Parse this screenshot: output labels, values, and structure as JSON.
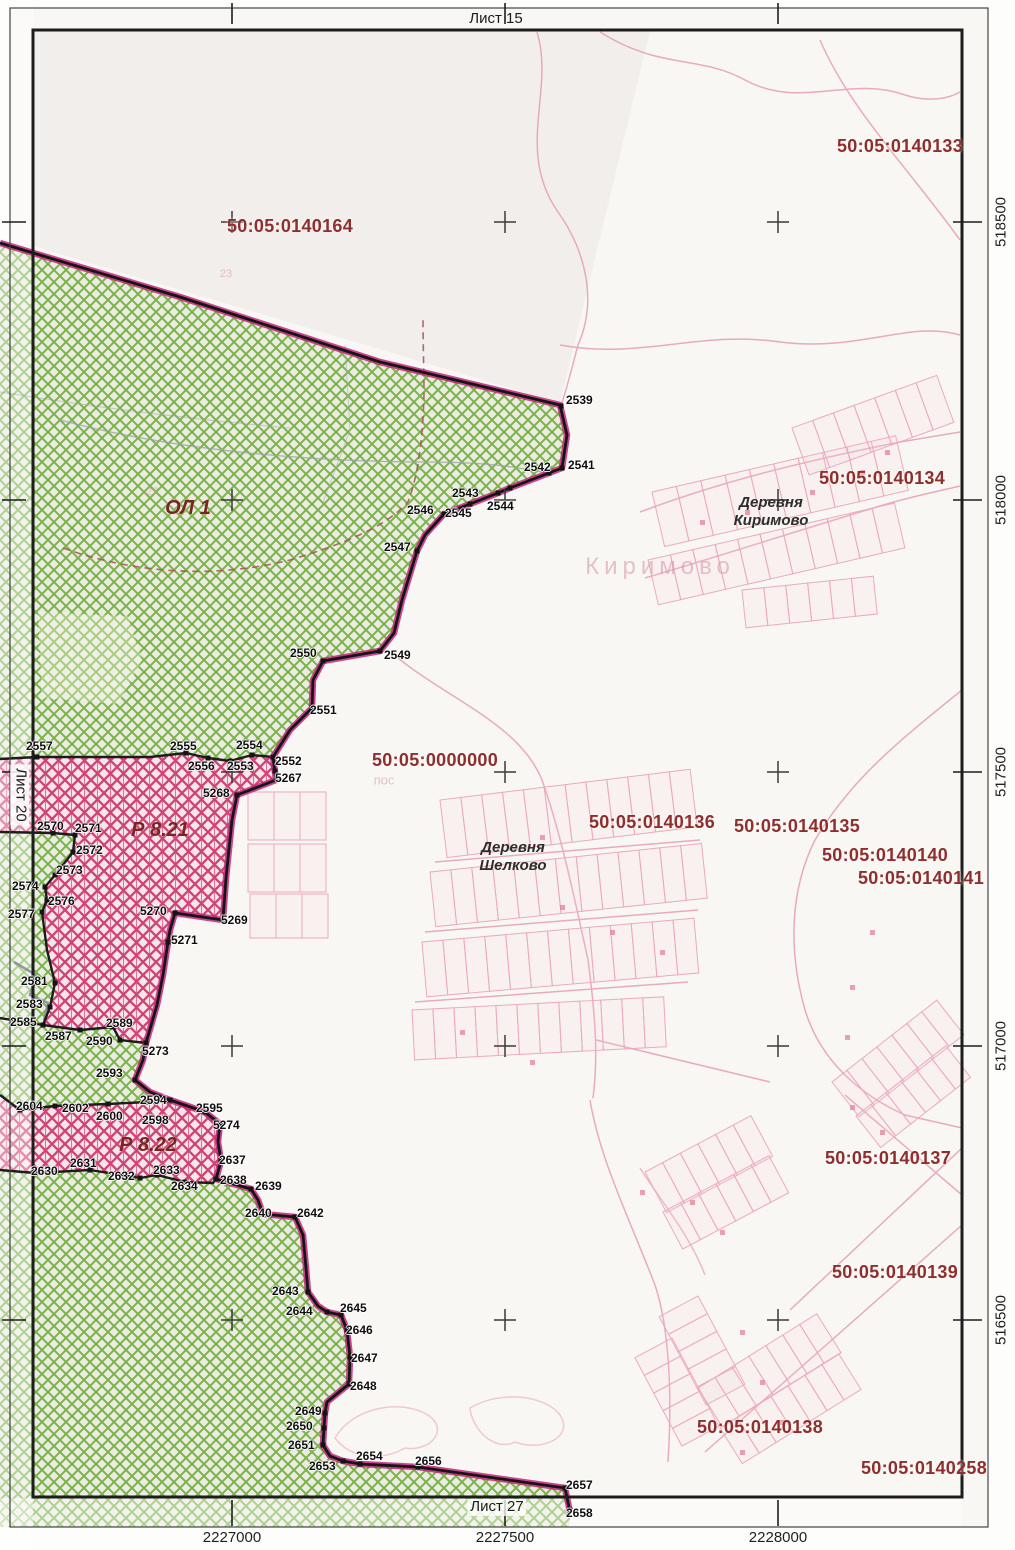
{
  "sheet": {
    "top": "Лист 15",
    "left": "Лист 20",
    "bottom": "Лист 27"
  },
  "grid": {
    "bottom_labels": [
      {
        "t": "2227000",
        "x": 232
      },
      {
        "t": "2227500",
        "x": 505
      },
      {
        "t": "2228000",
        "x": 778
      }
    ],
    "right_labels": [
      {
        "t": "518500",
        "y": 222
      },
      {
        "t": "518000",
        "y": 500
      },
      {
        "t": "517500",
        "y": 772
      },
      {
        "t": "517000",
        "y": 1046
      },
      {
        "t": "516500",
        "y": 1320
      }
    ]
  },
  "cadastral_quarters": [
    {
      "t": "50:05:0140133",
      "x": 900,
      "y": 146
    },
    {
      "t": "50:05:0140164",
      "x": 290,
      "y": 226
    },
    {
      "t": "50:05:0140134",
      "x": 882,
      "y": 478
    },
    {
      "t": "50:05:0000000",
      "x": 435,
      "y": 760
    },
    {
      "t": "50:05:0140136",
      "x": 652,
      "y": 822
    },
    {
      "t": "50:05:0140135",
      "x": 797,
      "y": 826
    },
    {
      "t": "50:05:0140140",
      "x": 885,
      "y": 855
    },
    {
      "t": "50:05:0140141",
      "x": 921,
      "y": 878
    },
    {
      "t": "50:05:0140137",
      "x": 888,
      "y": 1158
    },
    {
      "t": "50:05:0140139",
      "x": 895,
      "y": 1272
    },
    {
      "t": "50:05:0140138",
      "x": 760,
      "y": 1427
    },
    {
      "t": "50:05:0140258",
      "x": 924,
      "y": 1468
    }
  ],
  "regions": [
    {
      "t": "ОЛ 1",
      "x": 188,
      "y": 508
    },
    {
      "t": "Р 8.21",
      "x": 160,
      "y": 830
    },
    {
      "t": "Р 8.22",
      "x": 148,
      "y": 1145
    }
  ],
  "villages": [
    {
      "t": "Деревня\nКиримово",
      "x": 771,
      "y": 512
    },
    {
      "t": "Деревня\nШелково",
      "x": 513,
      "y": 857
    }
  ],
  "watermarks": [
    {
      "t": "Киримово",
      "x": 660,
      "y": 567,
      "size": 24
    },
    {
      "t": "пос",
      "x": 384,
      "y": 780,
      "size": 13
    },
    {
      "t": "23",
      "x": 226,
      "y": 274,
      "size": 11
    },
    {
      "t": "27",
      "x": 152,
      "y": 492,
      "size": 11
    }
  ],
  "points": [
    {
      "id": "2539",
      "lx": 566,
      "ly": 394,
      "vx": 561,
      "vy": 406
    },
    {
      "id": "2541",
      "lx": 568,
      "ly": 459,
      "vx": 562,
      "vy": 468
    },
    {
      "id": "2542",
      "lx": 524,
      "ly": 461,
      "vx": 549,
      "vy": 473
    },
    {
      "id": "2543",
      "lx": 452,
      "ly": 487,
      "vx": 510,
      "vy": 488
    },
    {
      "id": "2544",
      "lx": 487,
      "ly": 500,
      "vx": 498,
      "vy": 493
    },
    {
      "id": "2545",
      "lx": 445,
      "ly": 507,
      "vx": 470,
      "vy": 504
    },
    {
      "id": "2546",
      "lx": 407,
      "ly": 504,
      "vx": 444,
      "vy": 514
    },
    {
      "id": "2547",
      "lx": 384,
      "ly": 541,
      "vx": 417,
      "vy": 551
    },
    {
      "id": "2549",
      "lx": 384,
      "ly": 649,
      "vx": 380,
      "vy": 651
    },
    {
      "id": "2550",
      "lx": 290,
      "ly": 647,
      "vx": 323,
      "vy": 661
    },
    {
      "id": "2551",
      "lx": 310,
      "ly": 704,
      "vx": 312,
      "vy": 708
    },
    {
      "id": "2552",
      "lx": 275,
      "ly": 755,
      "vx": 273,
      "vy": 757
    },
    {
      "id": "5267",
      "lx": 275,
      "ly": 772,
      "vx": 275,
      "vy": 771
    },
    {
      "id": "2553",
      "lx": 227,
      "ly": 760,
      "vx": 230,
      "vy": 761
    },
    {
      "id": "2554",
      "lx": 236,
      "ly": 739,
      "vx": 252,
      "vy": 755
    },
    {
      "id": "2555",
      "lx": 170,
      "ly": 740,
      "vx": 186,
      "vy": 753
    },
    {
      "id": "2556",
      "lx": 188,
      "ly": 760,
      "vx": 208,
      "vy": 758
    },
    {
      "id": "2557",
      "lx": 26,
      "ly": 740,
      "vx": 37,
      "vy": 757
    },
    {
      "id": "5268",
      "lx": 203,
      "ly": 787,
      "vx": 237,
      "vy": 795
    },
    {
      "id": "2570",
      "lx": 37,
      "ly": 820,
      "vx": 53,
      "vy": 833
    },
    {
      "id": "2571",
      "lx": 75,
      "ly": 822,
      "vx": 75,
      "vy": 835
    },
    {
      "id": "2572",
      "lx": 76,
      "ly": 844,
      "vx": 73,
      "vy": 852
    },
    {
      "id": "2573",
      "lx": 56,
      "ly": 864,
      "vx": 55,
      "vy": 875
    },
    {
      "id": "2574",
      "lx": 12,
      "ly": 880,
      "vx": 45,
      "vy": 887
    },
    {
      "id": "2576",
      "lx": 48,
      "ly": 895,
      "vx": 47,
      "vy": 900
    },
    {
      "id": "2577",
      "lx": 8,
      "ly": 908,
      "vx": 42,
      "vy": 912
    },
    {
      "id": "5269",
      "lx": 221,
      "ly": 914,
      "vx": 223,
      "vy": 920
    },
    {
      "id": "5270",
      "lx": 140,
      "ly": 905,
      "vx": 175,
      "vy": 913
    },
    {
      "id": "5271",
      "lx": 171,
      "ly": 934,
      "vx": 168,
      "vy": 942
    },
    {
      "id": "2581",
      "lx": 21,
      "ly": 975,
      "vx": 55,
      "vy": 983
    },
    {
      "id": "2583",
      "lx": 16,
      "ly": 998,
      "vx": 50,
      "vy": 1007
    },
    {
      "id": "2585",
      "lx": 10,
      "ly": 1016,
      "vx": 43,
      "vy": 1025
    },
    {
      "id": "2587",
      "lx": 45,
      "ly": 1030,
      "vx": 80,
      "vy": 1030
    },
    {
      "id": "2589",
      "lx": 106,
      "ly": 1017,
      "vx": 113,
      "vy": 1027
    },
    {
      "id": "2590",
      "lx": 86,
      "ly": 1035,
      "vx": 120,
      "vy": 1040
    },
    {
      "id": "5273",
      "lx": 142,
      "ly": 1045,
      "vx": 146,
      "vy": 1043
    },
    {
      "id": "2593",
      "lx": 96,
      "ly": 1067,
      "vx": 135,
      "vy": 1080
    },
    {
      "id": "2594",
      "lx": 140,
      "ly": 1094,
      "vx": 170,
      "vy": 1100
    },
    {
      "id": "2595",
      "lx": 196,
      "ly": 1102,
      "vx": 205,
      "vy": 1112
    },
    {
      "id": "5274",
      "lx": 213,
      "ly": 1119,
      "vx": 220,
      "vy": 1124
    },
    {
      "id": "2598",
      "lx": 142,
      "ly": 1114,
      "vx": 147,
      "vy": 1102
    },
    {
      "id": "2600",
      "lx": 96,
      "ly": 1110,
      "vx": 108,
      "vy": 1104
    },
    {
      "id": "2602",
      "lx": 62,
      "ly": 1102,
      "vx": 55,
      "vy": 1106
    },
    {
      "id": "2604",
      "lx": 16,
      "ly": 1100,
      "vx": 20,
      "vy": 1110
    },
    {
      "id": "2630",
      "lx": 31,
      "ly": 1165,
      "vx": 35,
      "vy": 1173
    },
    {
      "id": "2631",
      "lx": 70,
      "ly": 1157,
      "vx": 90,
      "vy": 1170
    },
    {
      "id": "2632",
      "lx": 108,
      "ly": 1170,
      "vx": 140,
      "vy": 1178
    },
    {
      "id": "2633",
      "lx": 153,
      "ly": 1164,
      "vx": 157,
      "vy": 1175
    },
    {
      "id": "2634",
      "lx": 171,
      "ly": 1180,
      "vx": 185,
      "vy": 1182
    },
    {
      "id": "2637",
      "lx": 219,
      "ly": 1154,
      "vx": 221,
      "vy": 1161
    },
    {
      "id": "2638",
      "lx": 220,
      "ly": 1174,
      "vx": 216,
      "vy": 1179
    },
    {
      "id": "2639",
      "lx": 255,
      "ly": 1180,
      "vx": 251,
      "vy": 1189
    },
    {
      "id": "2640",
      "lx": 245,
      "ly": 1207,
      "vx": 263,
      "vy": 1214
    },
    {
      "id": "2642",
      "lx": 297,
      "ly": 1207,
      "vx": 295,
      "vy": 1217
    },
    {
      "id": "2643",
      "lx": 272,
      "ly": 1285,
      "vx": 308,
      "vy": 1292
    },
    {
      "id": "2644",
      "lx": 286,
      "ly": 1305,
      "vx": 327,
      "vy": 1312
    },
    {
      "id": "2645",
      "lx": 340,
      "ly": 1302,
      "vx": 341,
      "vy": 1315
    },
    {
      "id": "2646",
      "lx": 346,
      "ly": 1324,
      "vx": 347,
      "vy": 1330
    },
    {
      "id": "2647",
      "lx": 351,
      "ly": 1352,
      "vx": 350,
      "vy": 1357
    },
    {
      "id": "2648",
      "lx": 350,
      "ly": 1380,
      "vx": 349,
      "vy": 1384
    },
    {
      "id": "2649",
      "lx": 295,
      "ly": 1405,
      "vx": 325,
      "vy": 1413
    },
    {
      "id": "2650",
      "lx": 286,
      "ly": 1420,
      "vx": 324,
      "vy": 1428
    },
    {
      "id": "2651",
      "lx": 288,
      "ly": 1439,
      "vx": 323,
      "vy": 1445
    },
    {
      "id": "2653",
      "lx": 309,
      "ly": 1460,
      "vx": 343,
      "vy": 1461
    },
    {
      "id": "2654",
      "lx": 356,
      "ly": 1450,
      "vx": 360,
      "vy": 1464
    },
    {
      "id": "2656",
      "lx": 415,
      "ly": 1455,
      "vx": 418,
      "vy": 1467
    },
    {
      "id": "2657",
      "lx": 566,
      "ly": 1479,
      "vx": 565,
      "vy": 1488
    },
    {
      "id": "2658",
      "lx": 566,
      "ly": 1507,
      "vx": 570,
      "vy": 1510
    }
  ],
  "colors": {
    "green_hatch": "#7ab447",
    "pink_hatch": "#d14374",
    "boundary_magenta": "#c2267d",
    "boundary_black": "#151515",
    "quarter_text": "#8e2f2d",
    "parcel_pink": "#e7a2b2"
  }
}
